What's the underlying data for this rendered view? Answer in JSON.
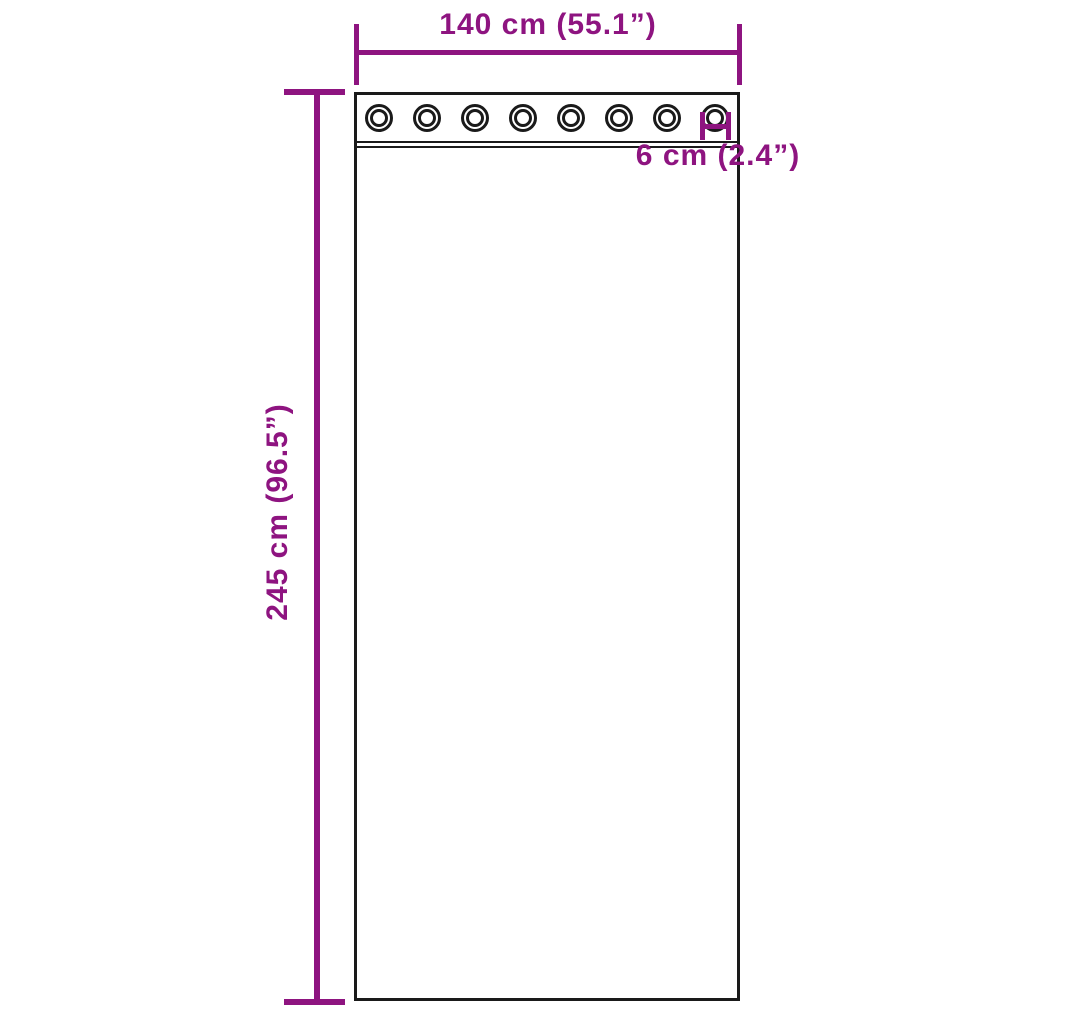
{
  "figure": {
    "type": "product-dimension-diagram",
    "subject": "curtain panel with grommets",
    "colors": {
      "accent": "#8E1480",
      "outline": "#1A1A1A",
      "background": "#FFFFFF"
    },
    "grommets": {
      "count": 8
    },
    "dimensions": {
      "width": {
        "label": "140 cm (55.1”)",
        "cm": 140,
        "inches": 55.1
      },
      "height": {
        "label": "245 cm (96.5”)",
        "cm": 245,
        "inches": 96.5
      },
      "grommet": {
        "label": "6 cm (2.4”)",
        "cm": 6,
        "inches": 2.4
      }
    }
  }
}
